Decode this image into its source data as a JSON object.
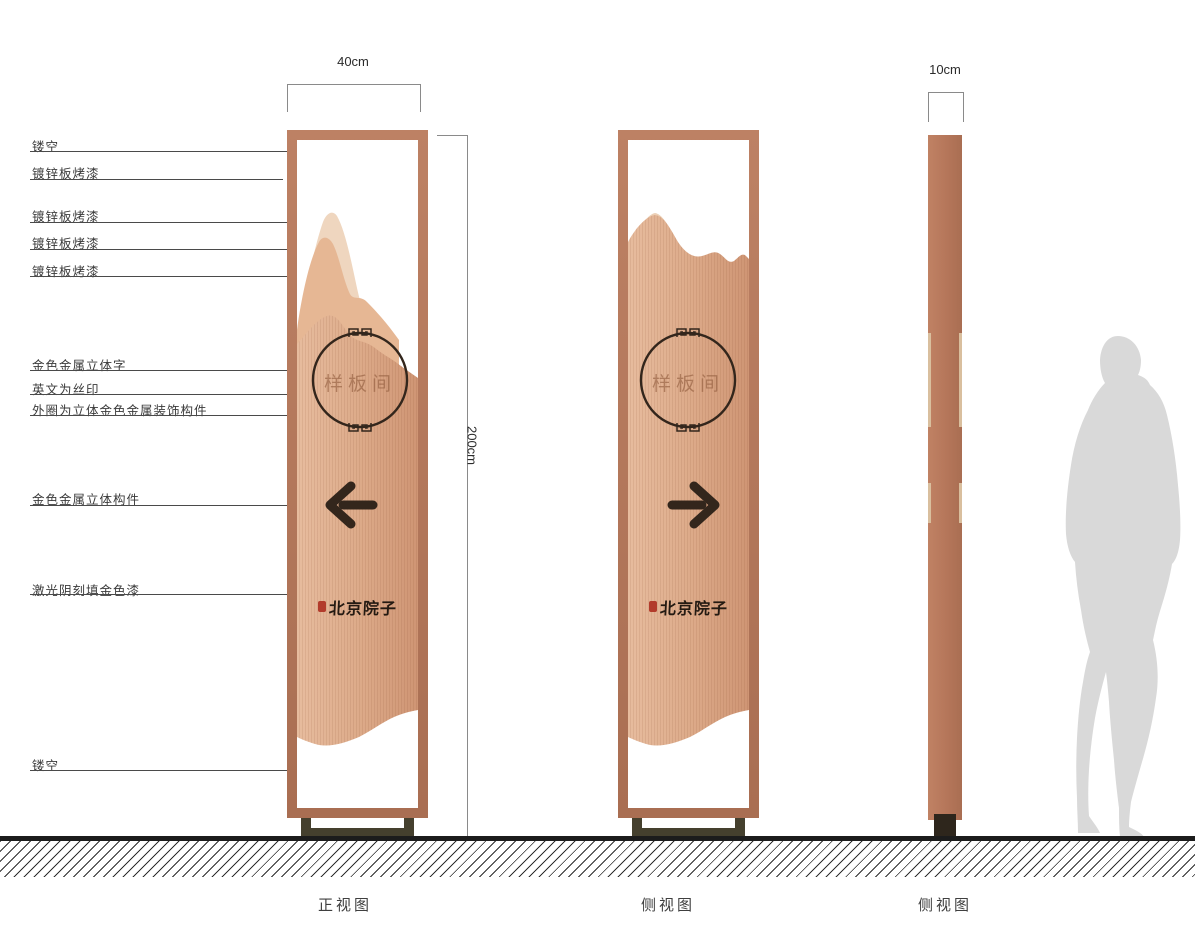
{
  "annotations": {
    "items": [
      {
        "text": "镂空"
      },
      {
        "text": "镀锌板烤漆"
      },
      {
        "text": "镀锌板烤漆"
      },
      {
        "text": "镀锌板烤漆"
      },
      {
        "text": "镀锌板烤漆"
      },
      {
        "text": "金色金属立体字"
      },
      {
        "text": "英文为丝印"
      },
      {
        "text": "外圈为立体金色金属装饰构件"
      },
      {
        "text": "金色金属立体构件"
      },
      {
        "text": "激光阴刻填金色漆"
      },
      {
        "text": "镂空"
      }
    ]
  },
  "dimensions": {
    "front_width": "40cm",
    "height": "200cm",
    "depth": "10cm"
  },
  "sign": {
    "room_label": "样板间",
    "brand": "北京院子"
  },
  "captions": {
    "front": "正视图",
    "side": "侧视图",
    "profile": "侧视图"
  },
  "colors": {
    "frame_copper": "#b3765a",
    "panel_light": "#e7bc9e",
    "panel_dark": "#cf9574",
    "mountain_back": "#efd6bf",
    "mountain_mid": "#e6b794",
    "ornament_dark": "#33261c",
    "seal_red": "#b23b2b",
    "base_olive": "#45402e",
    "silhouette_gray": "#d9d9d9"
  }
}
